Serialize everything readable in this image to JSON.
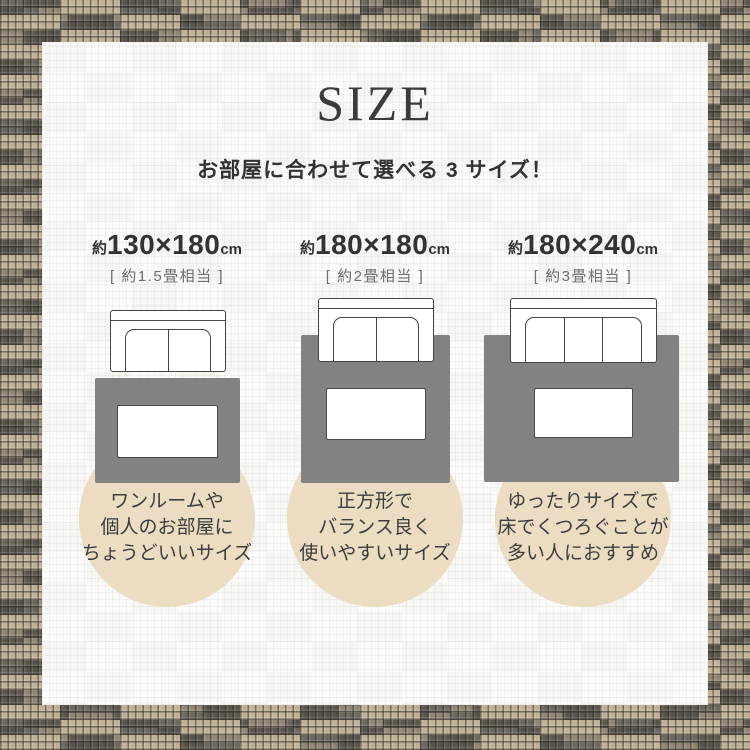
{
  "page": {
    "title": "SIZE",
    "subtitle": "お部屋に合わせて選べる 3 サイズ！"
  },
  "sizes": [
    {
      "approx": "約",
      "dimensions": "130×180",
      "unit": "cm",
      "tatami": "[ 約1.5畳相当 ]",
      "sofa_seats": 2,
      "desc_lines": [
        "ワンルームや",
        "個人のお部屋に",
        "ちょうどいいサイズ"
      ]
    },
    {
      "approx": "約",
      "dimensions": "180×180",
      "unit": "cm",
      "tatami": "[ 約2畳相当 ]",
      "sofa_seats": 2,
      "desc_lines": [
        "正方形で",
        "バランス良く",
        "使いやすいサイズ"
      ]
    },
    {
      "approx": "約",
      "dimensions": "180×240",
      "unit": "cm",
      "tatami": "[ 約3畳相当 ]",
      "sofa_seats": 3,
      "desc_lines": [
        "ゆったりサイズで",
        "床でくつろぐことが",
        "多い人におすすめ"
      ]
    }
  ],
  "colors": {
    "rug_fill": "#828282",
    "circle_fill": "#ebdcc2",
    "heading_text": "#333333",
    "tatami_text": "#6e6e6e",
    "border_weave_dark": "#524e46",
    "border_weave_tan": "#c7b69a",
    "panel_bg": "#f7f6f3"
  }
}
